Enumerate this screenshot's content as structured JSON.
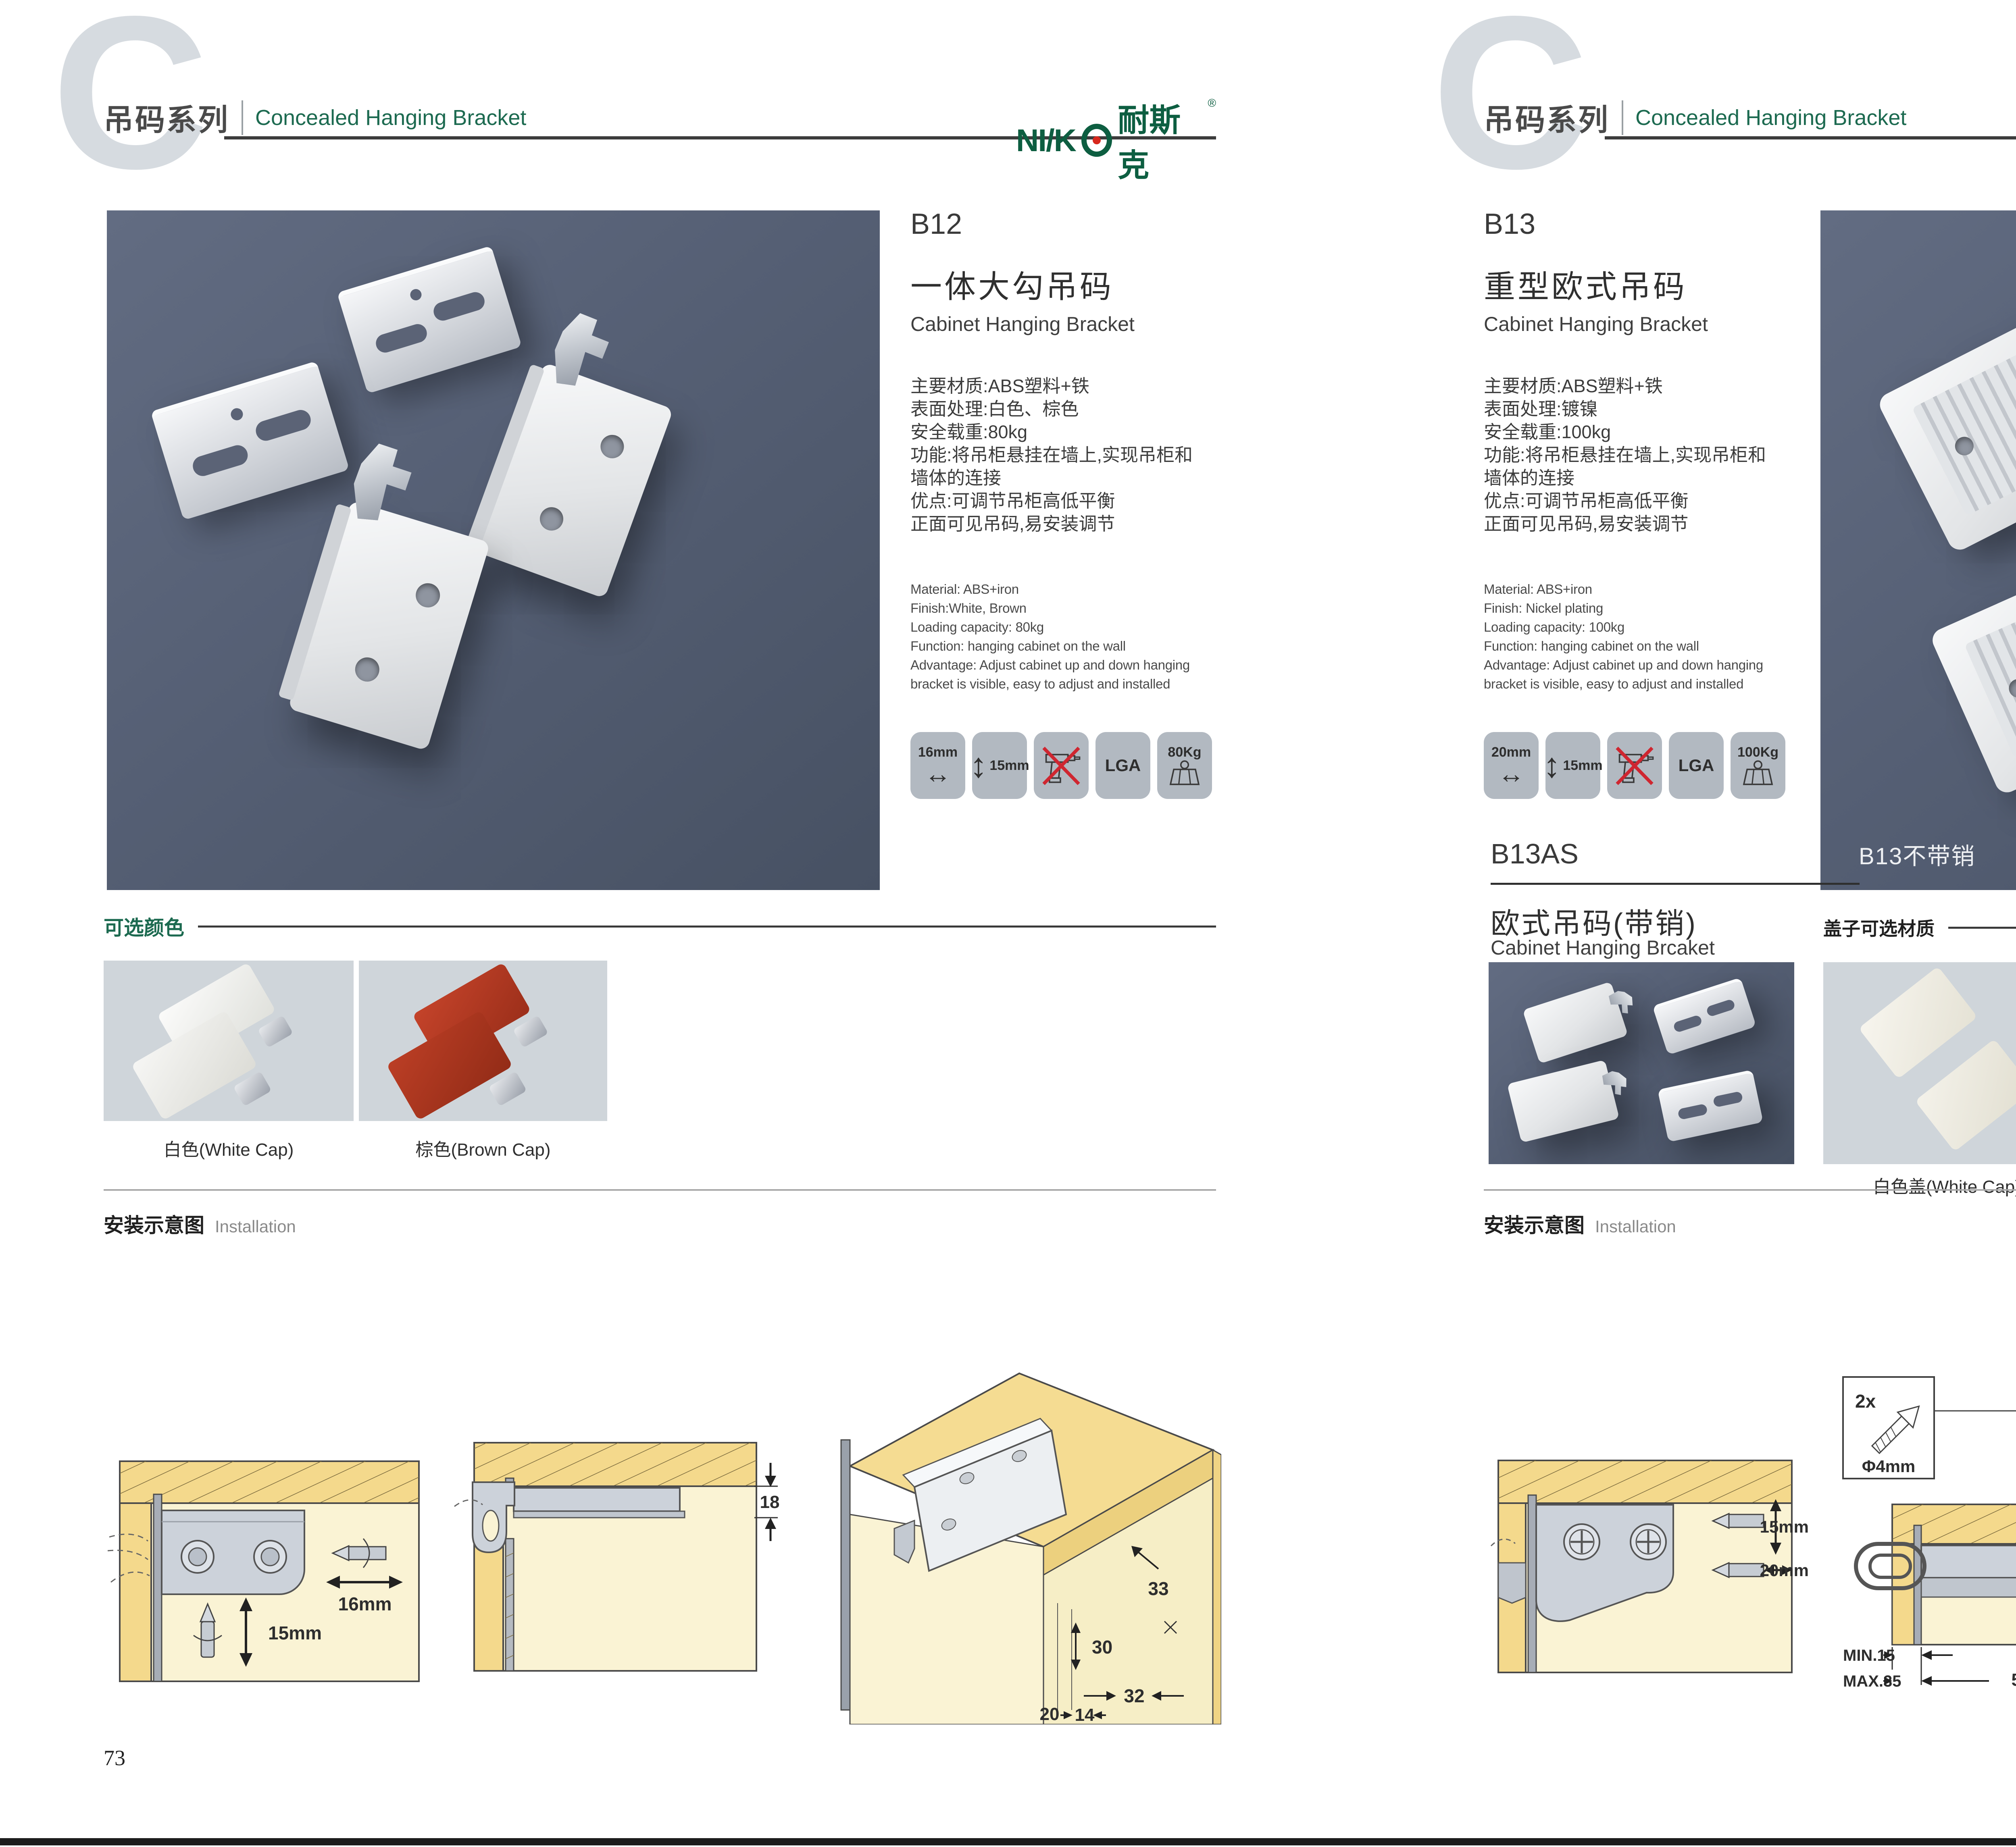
{
  "palette": {
    "accent_green": "#1c6a50",
    "logo_green": "#0d5e41",
    "logo_red": "#d7281d",
    "header_gray": "#4a4a4a",
    "photo_background": "#525c70",
    "swatch_background": "#cfd5da",
    "diagram_cream": "#faf3d4",
    "diagram_wood": "#f4d98c",
    "icon_tile_gray": "#b2b9c1",
    "brown_cap": "#b23b20"
  },
  "header": {
    "letter": "C",
    "series_cn": "吊码系列",
    "series_en": "Concealed Hanging Bracket",
    "logo_latin": "NI/K",
    "logo_cn": "耐斯克",
    "logo_reg": "®"
  },
  "footer": {
    "left_page": "73",
    "right_page": "74"
  },
  "left": {
    "code": "B12",
    "title_cn": "一体大勾吊码",
    "title_en": "Cabinet Hanging Bracket",
    "specs_cn": [
      "主要材质:ABS塑料+铁",
      "表面处理:白色、棕色",
      "安全载重:80kg",
      "功能:将吊柜悬挂在墙上,实现吊柜和",
      "墙体的连接",
      "优点:可调节吊柜高低平衡",
      "正面可见吊码,易安装调节"
    ],
    "specs_en": [
      "Material: ABS+iron",
      "Finish:White, Brown",
      "Loading capacity: 80kg",
      "Function: hanging cabinet on the wall",
      "Advantage: Adjust cabinet up and down hanging",
      "bracket is visible, easy to adjust and installed"
    ],
    "icons": {
      "width": "16mm",
      "height": "15mm",
      "cert": "LGA",
      "load": "80Kg"
    },
    "colors_title": "可选颜色",
    "color_captions": [
      "白色(White Cap)",
      "棕色(Brown Cap)"
    ],
    "install_cn": "安装示意图",
    "install_en": "Installation",
    "d1": {
      "w": "16mm",
      "h": "15mm"
    },
    "d2": {
      "t": "18"
    },
    "d3": {
      "a": "33",
      "b": "30",
      "c": "32",
      "d": "20",
      "e": "14"
    }
  },
  "right": {
    "code": "B13",
    "title_cn": "重型欧式吊码",
    "title_en": "Cabinet Hanging Bracket",
    "specs_cn": [
      "主要材质:ABS塑料+铁",
      "表面处理:镀镍",
      "安全载重:100kg",
      "功能:将吊柜悬挂在墙上,实现吊柜和",
      "墙体的连接",
      "优点:可调节吊柜高低平衡",
      "正面可见吊码,易安装调节"
    ],
    "specs_en": [
      "Material: ABS+iron",
      "Finish: Nickel plating",
      "Loading capacity: 100kg",
      "Function: hanging cabinet on the wall",
      "Advantage: Adjust cabinet up and down hanging",
      "bracket is visible, easy to adjust and installed"
    ],
    "icons": {
      "width": "20mm",
      "height": "15mm",
      "cert": "LGA",
      "load": "100Kg"
    },
    "photo_label": "B13不带销",
    "sub_code": "B13AS",
    "sub_title_cn": "欧式吊码(带销)",
    "sub_title_en": "Cabinet Hanging Brcaket",
    "covers_title": "盖子可选材质",
    "cover_captions": [
      "白色盖(White Cap)",
      "灰色盖(Gray Cap)"
    ],
    "install_cn": "安装示意图",
    "install_en": "Installation",
    "d1": {
      "h": "15mm",
      "w": "20mm"
    },
    "d2": {
      "qty": "2x",
      "dia": "Φ4mm",
      "t": "18",
      "min": "MIN.15",
      "max": "MAX.35",
      "len": "58"
    },
    "d3": {
      "a": "16",
      "b": "40",
      "r": "RMAX4",
      "c": "19",
      "d": "18",
      "e": "32"
    }
  }
}
